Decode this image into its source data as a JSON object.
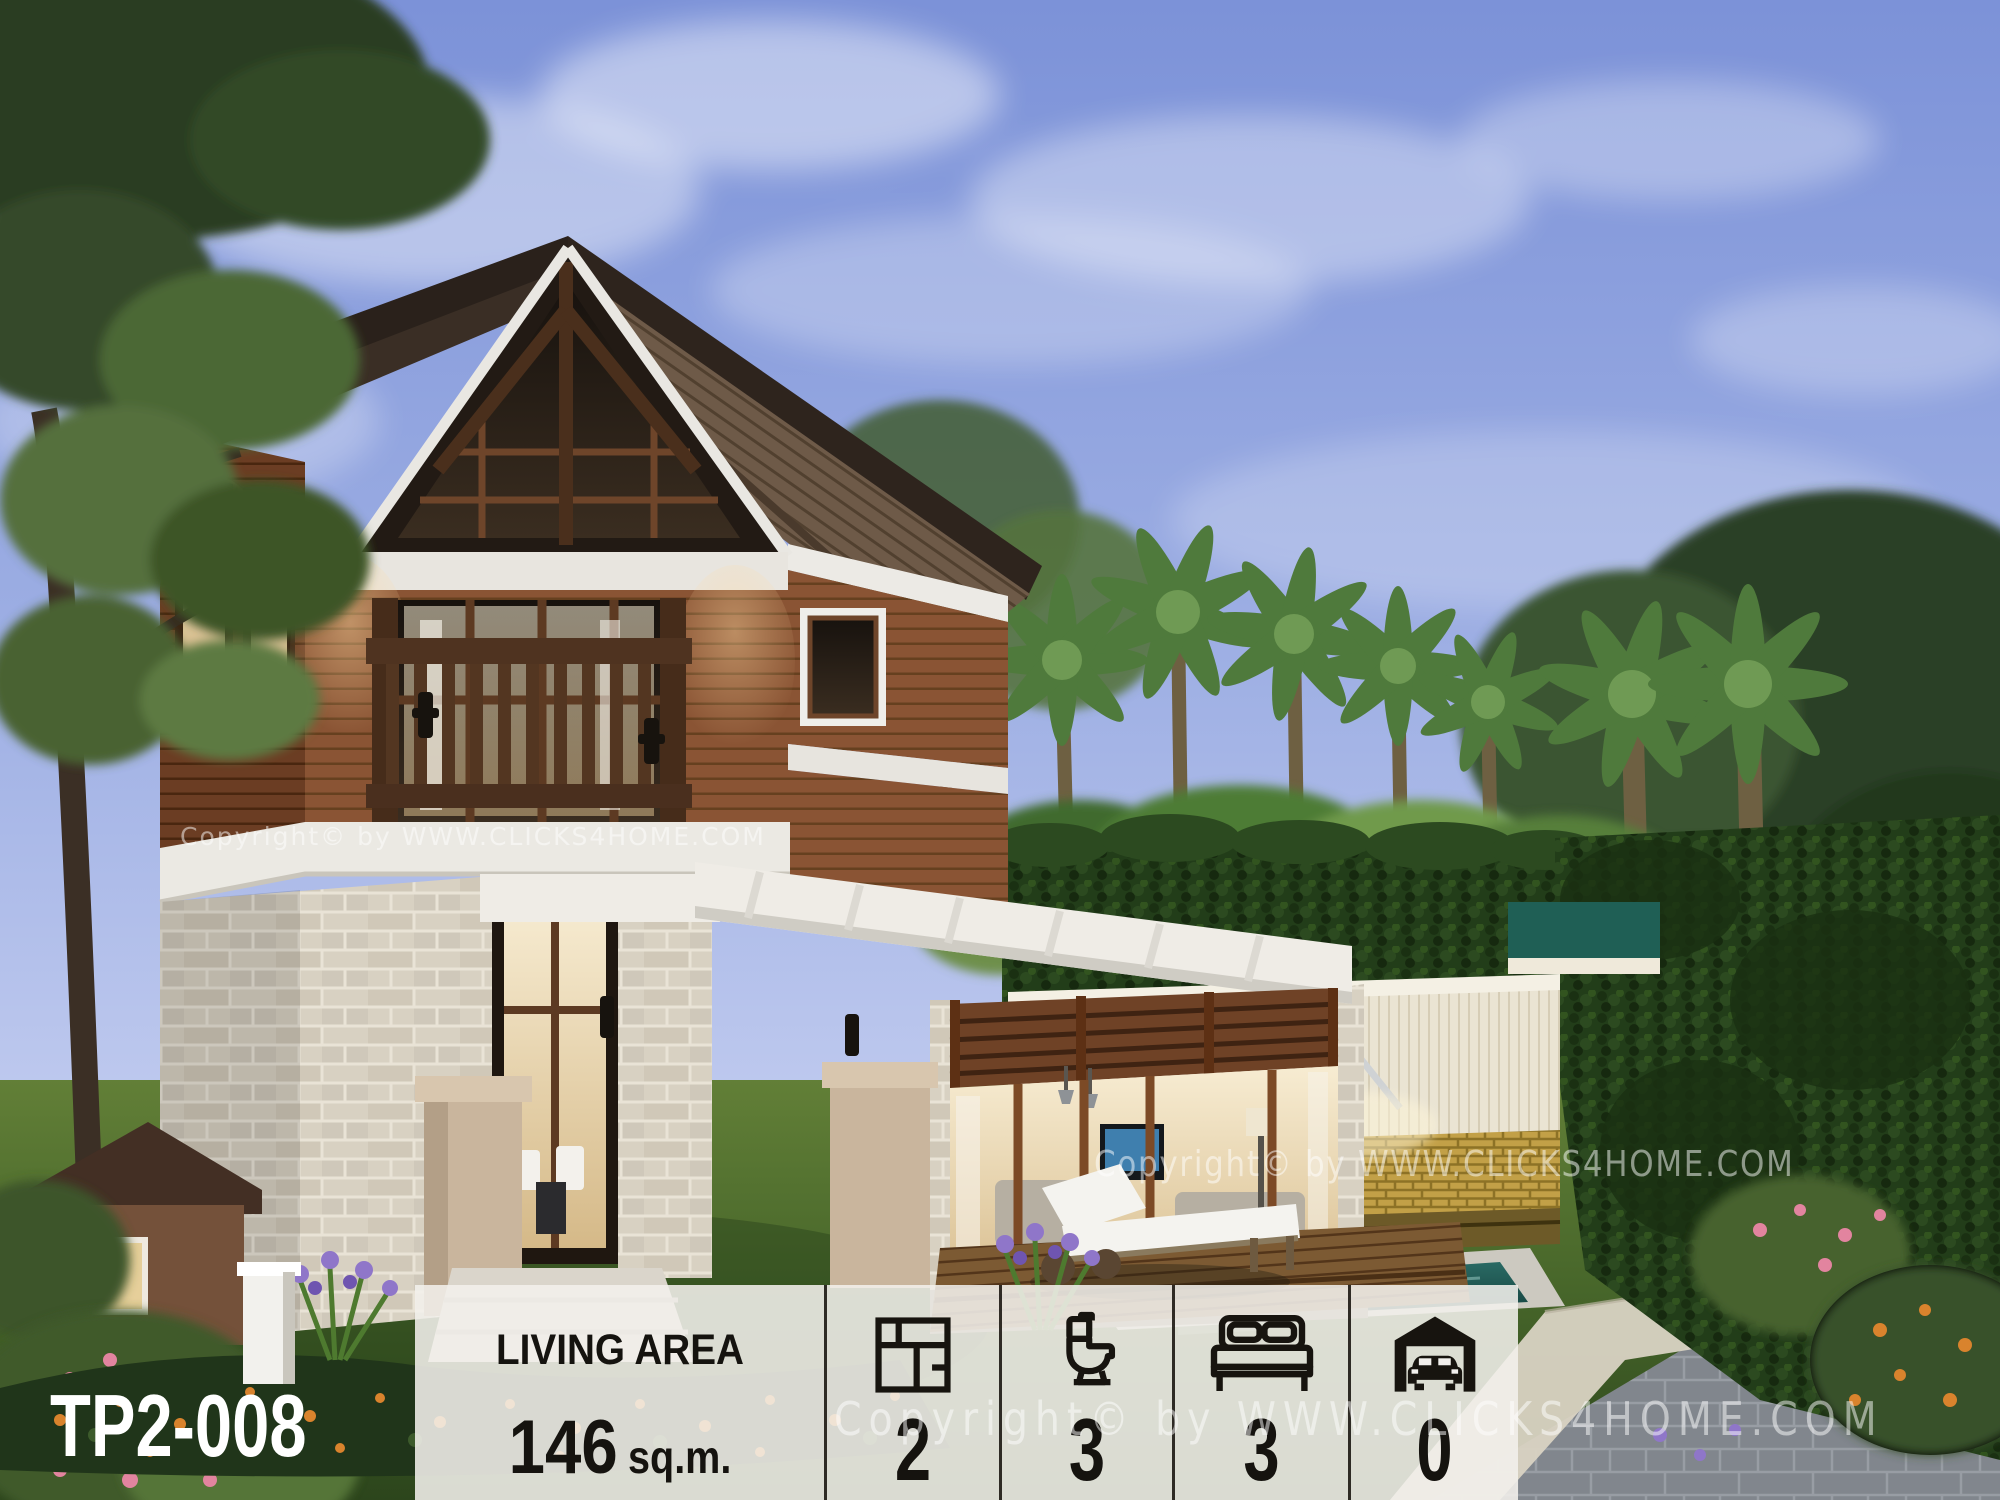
{
  "scene": {
    "description": "3D exterior rendering of a two-storey tropical wood-and-stone house with balcony, pool, palm trees and garden at dusk",
    "model_code": "TP2-008",
    "watermark_text": "Copyright© by WWW.CLICKS4HOME.COM"
  },
  "panel": {
    "living_area": {
      "label": "LIVING AREA",
      "value": "146",
      "unit": "sq.m."
    },
    "stats": [
      {
        "id": "storeys",
        "icon": "floorplan-icon",
        "value": "2"
      },
      {
        "id": "bathrooms",
        "icon": "toilet-icon",
        "value": "3"
      },
      {
        "id": "bedrooms",
        "icon": "bed-icon",
        "value": "3"
      },
      {
        "id": "carpark",
        "icon": "garage-icon",
        "value": "0"
      }
    ]
  },
  "colors": {
    "panel-bg": "rgba(242,240,236,0.88)",
    "separator-color": "#1c1712",
    "panel-text": "#15130f",
    "model-code-color": "#ffffff",
    "watermark-color": "rgba(255,255,255,0.5)",
    "sky-top": "#7c92d8",
    "sky-horizon": "#d7dcf4",
    "roof-dark": "#31271f",
    "roof-soffit": "#6e5a48",
    "wood-siding": "#8a5434",
    "wood-frame": "#5d3014",
    "trim-white": "#eceae5",
    "stone-beige": "#d8d1c2",
    "glass-warm": "#ecd8ab",
    "hedge-green": "#223d19",
    "lawn-green": "#4f7030",
    "deck-wood": "#7c5a33",
    "pool-teal": "#1f5f55",
    "paver-gray": "#81868d",
    "flower-orange": "#d9832d",
    "flower-purple": "#8f76c9",
    "flower-pink": "#e2849f"
  }
}
